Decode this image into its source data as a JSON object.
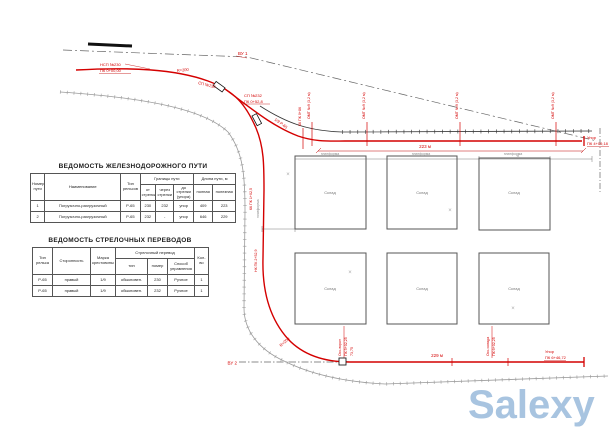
{
  "tables": {
    "track": {
      "title": "ВЕДОМОСТЬ  ЖЕЛЕЗНОДОРОЖНОГО ПУТИ",
      "h_number": "Номер пути",
      "h_name": "Наименование",
      "h_rail": "Тип рельсов",
      "h_bounds": "Границы пути",
      "h_from": "от стрелки",
      "h_through": "через стрелки",
      "h_to": "до стрелки (упора)",
      "h_len": "Длина пути, м",
      "h_full": "полная",
      "h_useful": "полезная",
      "rows": [
        {
          "num": "1",
          "name": "Погрузочно-разгрузочный",
          "rail": "Р-65",
          "from": "230",
          "through": "232",
          "to": "упор",
          "full": "409",
          "useful": "223"
        },
        {
          "num": "2",
          "name": "Погрузочно-разгрузочный",
          "rail": "Р-65",
          "from": "232",
          "through": "-",
          "to": "упор",
          "full": "646",
          "useful": "229"
        }
      ]
    },
    "switches": {
      "title": "ВЕДОМОСТЬ СТРЕЛОЧНЫХ ПЕРЕВОДОВ",
      "h_rail": "Тип рельса",
      "h_side": "Сторонность",
      "h_mark": "Марка крестовины",
      "h_turnout": "Стрелочный перевод",
      "h_type": "тип",
      "h_num": "номер",
      "h_control": "Способ управления",
      "h_qty": "Кол-во",
      "rows": [
        {
          "rail": "Р-65",
          "side": "правый",
          "mark": "1/9",
          "type": "обыкновен.",
          "num": "230",
          "control": "Ручное",
          "qty": "1"
        },
        {
          "rail": "Р-65",
          "side": "правый",
          "mark": "1/9",
          "type": "обыкновен.",
          "num": "232",
          "control": "Ручное",
          "qty": "1"
        }
      ]
    }
  },
  "plan": {
    "vu1": "ВУ 1",
    "vu2": "ВУ 2",
    "start1": "НСП №230",
    "start2": "ПК 0+00,00",
    "sw1": "СП №230",
    "sw2a": "СП №232",
    "sw2b": "ПК 0+52,8",
    "curve_top": "R=200",
    "branch": "1/9 Р-65",
    "kk0": "КК ПК 0+86",
    "kk1": "КК ПК 1+02,5",
    "nk2": "НК ПК 2+52,9",
    "r_bottom": "R=200",
    "omt": "ОМТ №9 (3,2 м)",
    "upor1a": "Упор",
    "upor1b": "ПК 4+09,18",
    "upor2a": "Упор",
    "upor2b": "ПК 6+46,72",
    "dim_top": "223 м",
    "dim_bot": "229 м",
    "gate1a": "Ось ворот",
    "gate1b": "ПК 5+02,25",
    "gate1c": "73,75",
    "gate2a": "Ось склада",
    "gate2b": "ПК 6+02,25",
    "platform": "платформа",
    "ramp": "платформа",
    "building": "Склад",
    "cross": "×"
  },
  "colors": {
    "track_red": "#d40000",
    "line_dark": "#333333",
    "line_gray": "#999999",
    "watermark_blue": "#a8c4e0"
  },
  "watermark": {
    "text": "Salexy"
  }
}
